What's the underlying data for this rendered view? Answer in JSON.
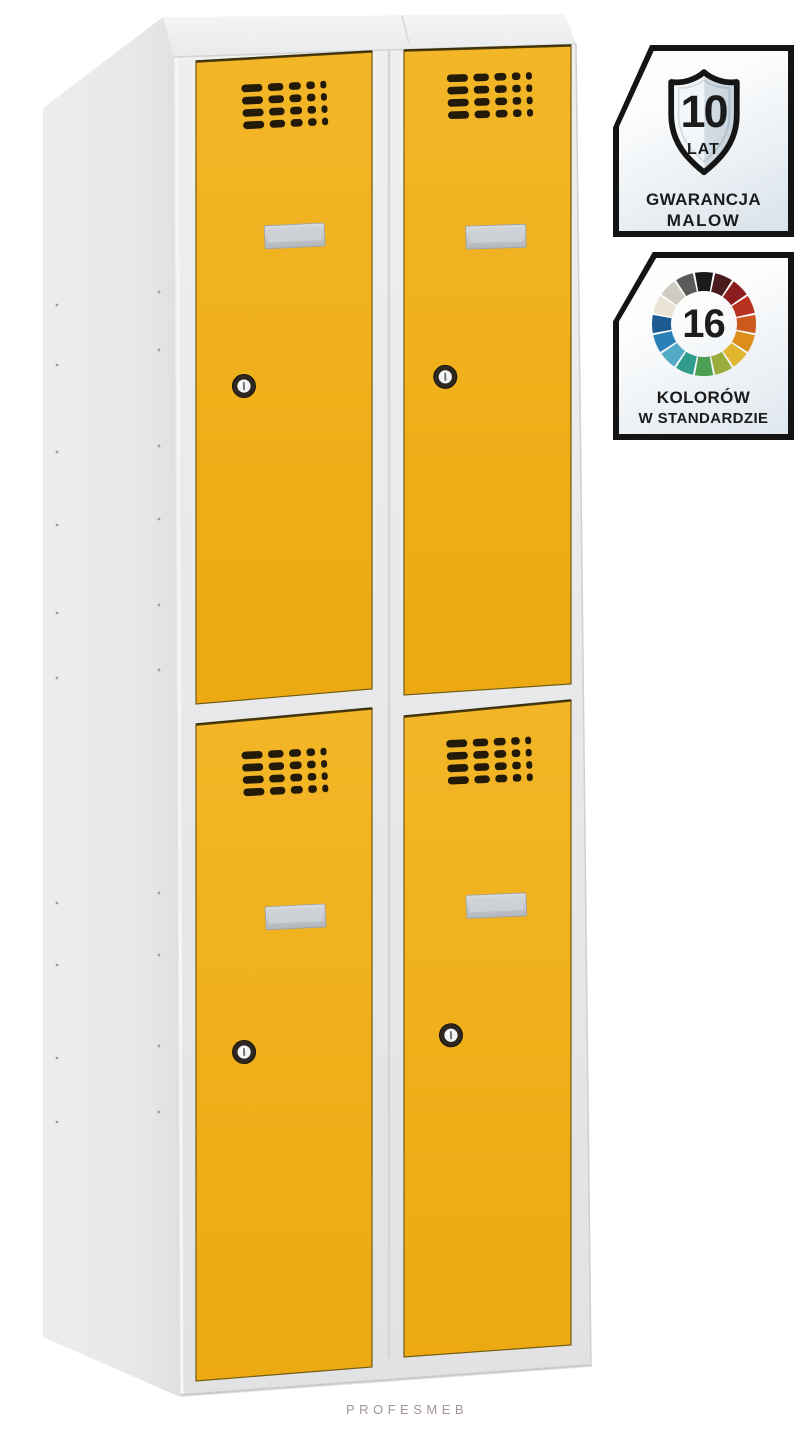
{
  "product_image": {
    "type": "metal-wardrobe-locker-two-columns-four-yellow-doors",
    "doors": [
      "upper-left",
      "upper-right",
      "lower-left",
      "lower-right"
    ],
    "door_features": [
      "vent-grille",
      "label-holder",
      "cylinder-lock"
    ]
  },
  "colors": {
    "door_yellow": "#f0ae19",
    "vent": "#241a08",
    "body_gray": "#e8e9ea",
    "label_plate": "#c9ccd2",
    "badge_border": "#141414",
    "watermark": "#a2939a"
  },
  "badges": {
    "warranty": {
      "value": "10",
      "unit": "LAT",
      "line1": "GWARANCJA",
      "line2": "MALOW"
    },
    "colors": {
      "value": "16",
      "line1": "KOLORÓW",
      "line2": "W STANDARDZIE",
      "wheel_colors": [
        "#1a1a1a",
        "#4b1a1d",
        "#8c1d1f",
        "#b93220",
        "#cc5a1c",
        "#dd8d1a",
        "#e0b52f",
        "#9aad3a",
        "#4f9e55",
        "#2f9c8c",
        "#52aac4",
        "#2b80b5",
        "#1d5b92",
        "#e9e4d3",
        "#cfccc2",
        "#5a5a58"
      ]
    }
  },
  "watermark": {
    "text": "PROFESMEB"
  }
}
